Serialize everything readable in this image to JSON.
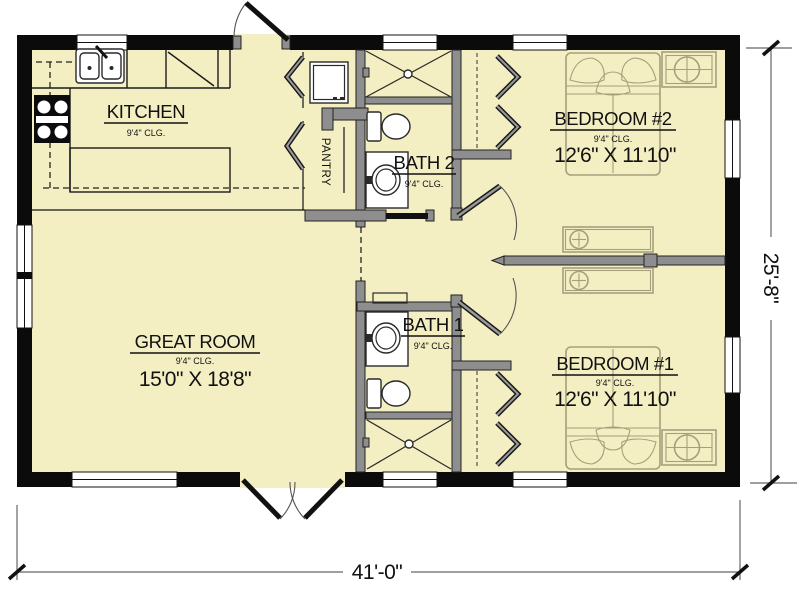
{
  "plan": {
    "type": "single-story house floor plan",
    "colors": {
      "paper": "#ffffff",
      "floor": "#f4efc3",
      "exterior_wall": "#0b0b0b",
      "interior_wall": "#8e8e8e",
      "furniture_outline": "#a59f7d"
    },
    "rooms": {
      "kitchen": {
        "name": "KITCHEN",
        "ceiling": "9'4\" CLG."
      },
      "great_room": {
        "name": "GREAT ROOM",
        "ceiling": "9'4\" CLG.",
        "size": "15'0\" X 18'8\""
      },
      "pantry": {
        "name": "PANTRY"
      },
      "bath_2": {
        "name": "BATH 2",
        "ceiling": "9'4\" CLG."
      },
      "bath_1": {
        "name": "BATH 1",
        "ceiling": "9'4\" CLG."
      },
      "bedroom_2": {
        "name": "BEDROOM #2",
        "ceiling": "9'4\" CLG.",
        "size": "12'6\" X 11'10\""
      },
      "bedroom_1": {
        "name": "BEDROOM #1",
        "ceiling": "9'4\" CLG.",
        "size": "12'6\" X 11'10\""
      }
    },
    "dimensions": {
      "overall_width": "41'-0\"",
      "overall_depth": "25'-8\""
    }
  }
}
